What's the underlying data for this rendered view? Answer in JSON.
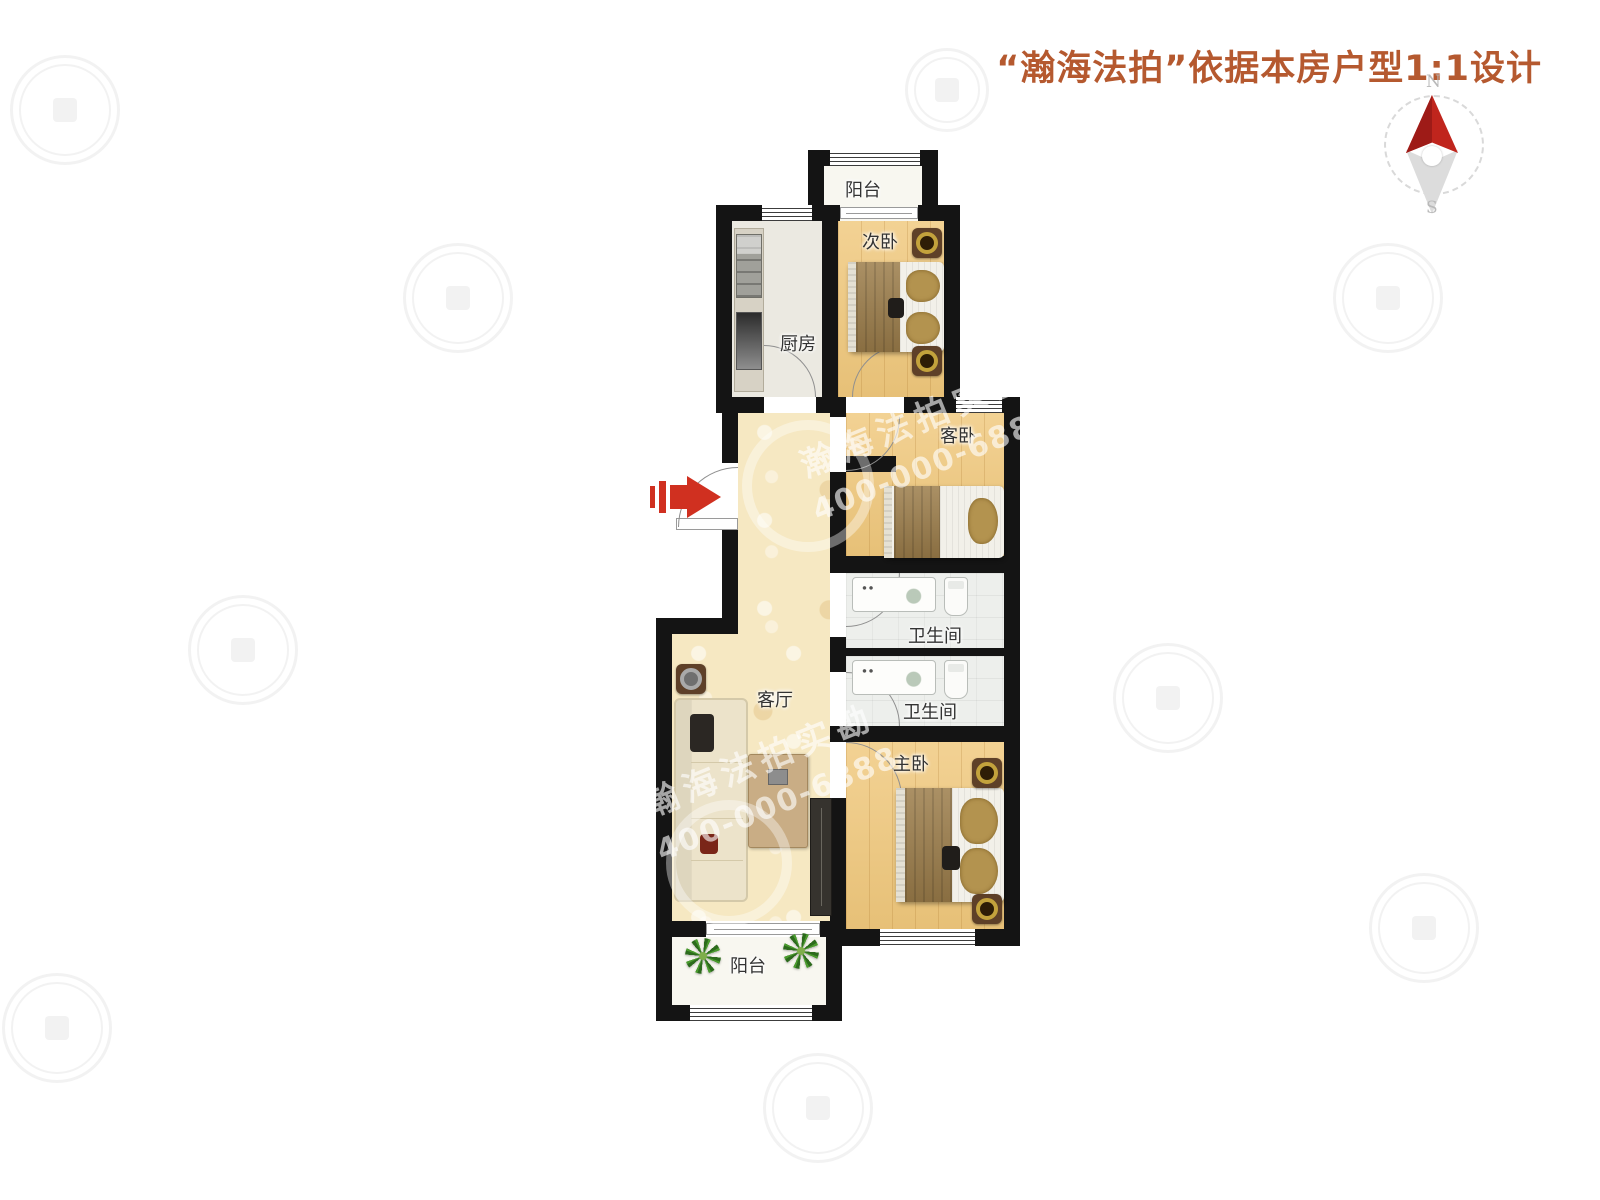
{
  "title": {
    "text": "“瀚海法拍”依据本房户型1:1设计",
    "color": "#b5592f"
  },
  "compass": {
    "north_label": "N",
    "south_label": "S",
    "needle_color": "#c0251d"
  },
  "watermark": {
    "brand": "瀚海法拍实勘",
    "phone": "400-000-6888"
  },
  "rooms": [
    {
      "id": "balcony-top",
      "label": "阳台"
    },
    {
      "id": "bedroom-second",
      "label": "次卧"
    },
    {
      "id": "kitchen",
      "label": "厨房"
    },
    {
      "id": "bedroom-guest",
      "label": "客卧"
    },
    {
      "id": "bathroom-upper",
      "label": "卫生间"
    },
    {
      "id": "bathroom-lower",
      "label": "卫生间"
    },
    {
      "id": "living-room",
      "label": "客厅"
    },
    {
      "id": "bedroom-master",
      "label": "主卧"
    },
    {
      "id": "balcony-bottom",
      "label": "阳台"
    }
  ],
  "colors": {
    "wall": "#141414",
    "wood_floor": "#f0c87c",
    "marble_floor": "#f6e8c2",
    "tile_floor": "#edefec",
    "entry_arrow": "#d03020",
    "title_accent": "#b5592f"
  },
  "icons": {
    "compass": "compass-rose",
    "entrance": "red-right-arrow",
    "plant": "green-plant",
    "speaker": "ceiling-speaker"
  }
}
